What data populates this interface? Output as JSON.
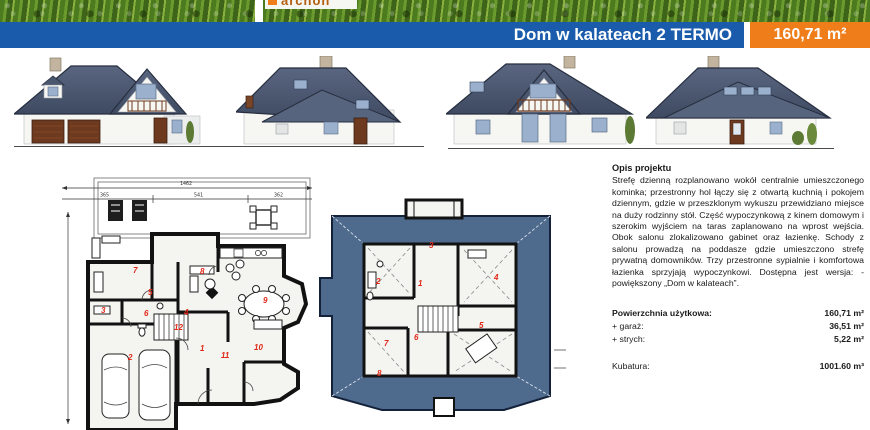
{
  "colors": {
    "banner_blue": "#1a5cab",
    "badge_orange": "#ef7d1a",
    "accent_red": "#e02818",
    "roof": "#4d5972",
    "plan_roof": "#4e6a8c"
  },
  "header": {
    "logo_text": "archon",
    "title": "Dom w kalateach 2 TERMO",
    "area": "160,71 m²"
  },
  "plans": {
    "ground": {
      "dim_total": "1462",
      "dim_segments": [
        "365",
        "541",
        "362"
      ],
      "rooms": [
        {
          "n": "7",
          "x": 75,
          "y": 101
        },
        {
          "n": "8",
          "x": 142,
          "y": 102
        },
        {
          "n": "5",
          "x": 90,
          "y": 123
        },
        {
          "n": "9",
          "x": 205,
          "y": 131
        },
        {
          "n": "3",
          "x": 43,
          "y": 141
        },
        {
          "n": "6",
          "x": 86,
          "y": 144
        },
        {
          "n": "4",
          "x": 126,
          "y": 143
        },
        {
          "n": "12",
          "x": 116,
          "y": 158
        },
        {
          "n": "1",
          "x": 142,
          "y": 179
        },
        {
          "n": "2",
          "x": 70,
          "y": 188
        },
        {
          "n": "11",
          "x": 163,
          "y": 186
        },
        {
          "n": "10",
          "x": 196,
          "y": 178
        }
      ]
    },
    "attic": {
      "rooms": [
        {
          "n": "3",
          "x": 111,
          "y": 50
        },
        {
          "n": "2",
          "x": 58,
          "y": 86
        },
        {
          "n": "1",
          "x": 100,
          "y": 88
        },
        {
          "n": "4",
          "x": 176,
          "y": 82
        },
        {
          "n": "5",
          "x": 161,
          "y": 130
        },
        {
          "n": "6",
          "x": 96,
          "y": 142
        },
        {
          "n": "7",
          "x": 66,
          "y": 148
        },
        {
          "n": "8",
          "x": 59,
          "y": 178
        }
      ]
    }
  },
  "description": {
    "heading": "Opis projektu",
    "body": "Strefę dzienną rozplanowano wokół centralnie umieszczonego kominka; przestronny hol łączy się z otwartą kuchnią i pokojem dziennym, gdzie w przeszklonym wykuszu przewidziano miejsce na duży rodzinny stół. Część wypoczynkową z kinem domowym i szerokim wyjściem na taras zaplanowano na wprost wejścia. Obok salonu zlokalizowano gabinet oraz łazienkę. Schody z salonu prowadzą na poddasze gdzie umieszczono strefę prywatną domowników. Trzy przestronne sypialnie i komfortowa łazienka sprzyjają wypoczynkowi. Dostępna jest wersja: -powiększony „Dom w kalateach”."
  },
  "specs": {
    "rows": [
      {
        "label": "Powierzchnia użytkowa:",
        "value": "160,71 m²",
        "bold": true
      },
      {
        "label": "+ garaż:",
        "value": "36,51 m²"
      },
      {
        "label": "+ strych:",
        "value": "5,22 m²"
      },
      {
        "label": "Kubatura:",
        "value": "1001.60 m³",
        "gap": true
      }
    ]
  }
}
